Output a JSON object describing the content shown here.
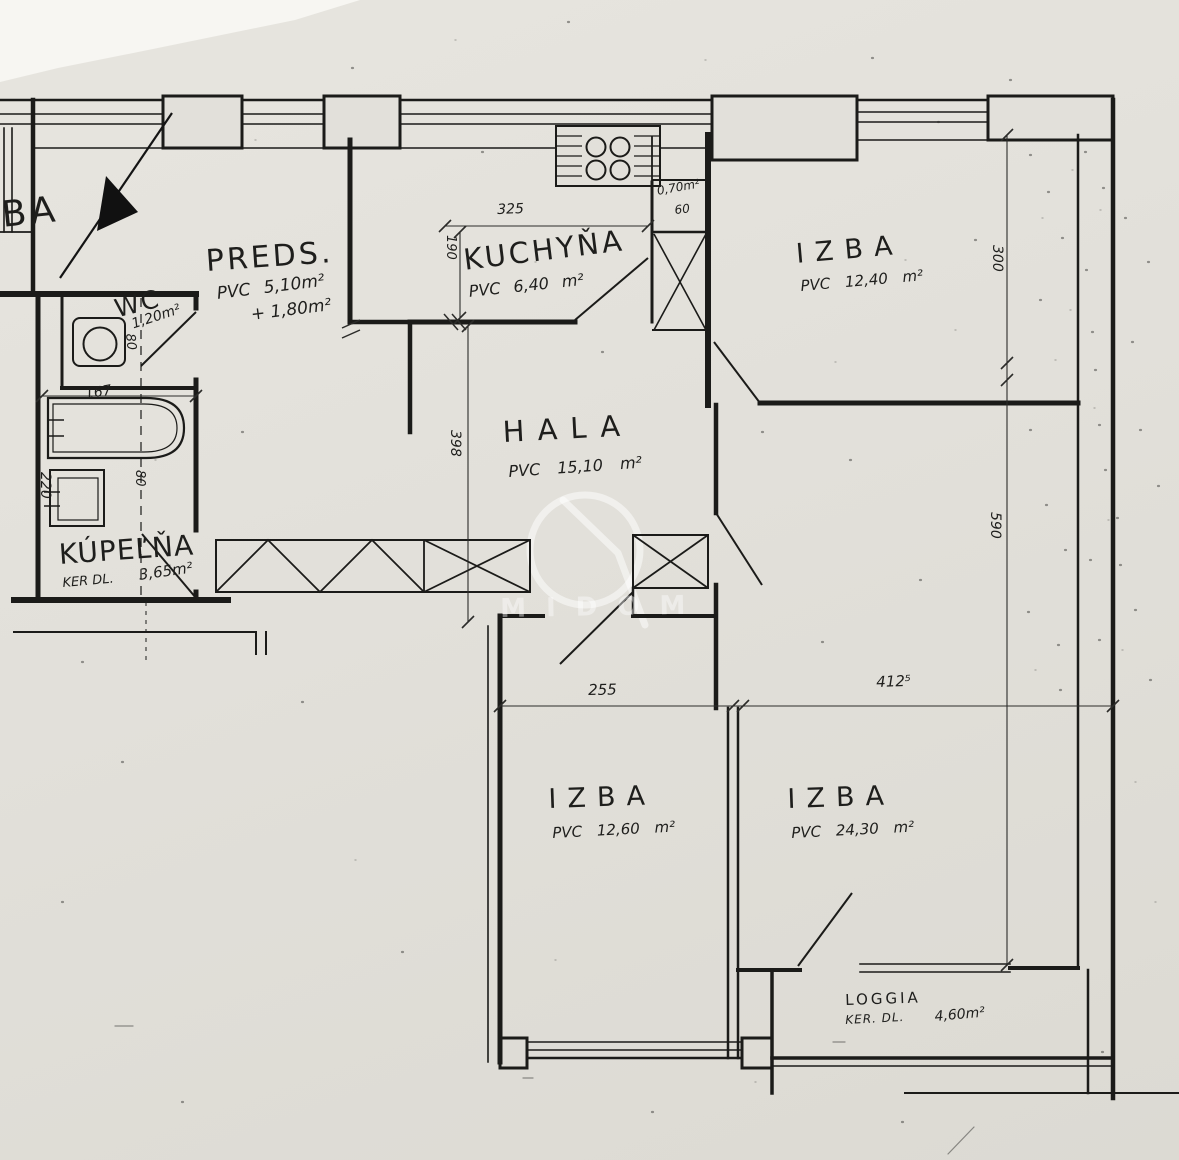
{
  "labels": {
    "ba": "BA",
    "preds": {
      "name": "PREDS.",
      "l1": "PVC 5,10m²",
      "l2": "+ 1,80m²"
    },
    "kuchyna": {
      "name": "KUCHYŇA",
      "l1": "PVC 6,40 m²"
    },
    "izba_tr": {
      "name": "IZBA",
      "l1": "PVC 12,40 m²"
    },
    "hala": {
      "name": "HALA",
      "l1": "PVC 15,10 m²"
    },
    "wc": {
      "name": "WC",
      "l1": "1,20m²"
    },
    "kupelna": {
      "name": "KÚPEĽŇA",
      "l1": "KER DL.",
      "l2": "3,65m²"
    },
    "izba_bl": {
      "name": "IZBA",
      "l1": "PVC 12,60 m²"
    },
    "izba_br": {
      "name": "IZBA",
      "l1": "PVC 24,30 m²"
    },
    "loggia": {
      "name": "LOGGIA",
      "l1": "KER. DL.",
      "l2": "4,60m²"
    },
    "shaft": {
      "l1": "0,70m²",
      "l2": "60"
    }
  },
  "dims": {
    "d325": "325",
    "d190": "190",
    "d300": "300",
    "d398": "398",
    "d590": "590",
    "d255": "255",
    "d412": "412⁵",
    "d167": "167",
    "d220": "220",
    "d80_bath": "80",
    "d80_wc": "80"
  },
  "watermark": "MIDOM",
  "ink_color": "#1b1b19",
  "paper_color": "#e2e0da"
}
